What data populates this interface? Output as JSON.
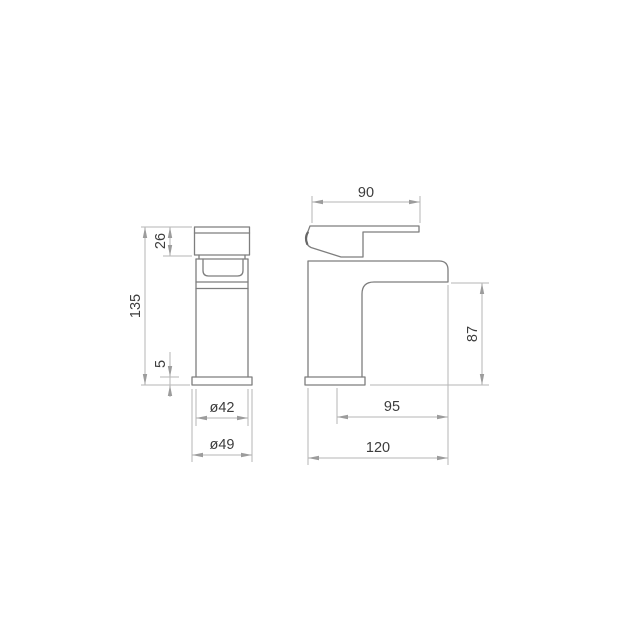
{
  "page": {
    "background": "#ffffff"
  },
  "drawing": {
    "title": "basin-mixer-tap-dimension-drawing",
    "units": "mm",
    "palette": {
      "object_line": "#7e7e7e",
      "dimension_line": "#b6b6b6",
      "arrow": "#9c9c9c",
      "text": "#3d3d3d",
      "background": "#ffffff"
    },
    "front_view": {
      "dimensions": {
        "total_height": "135",
        "handle_height": "26",
        "base_plate_height": "5",
        "body_diameter": "ø42",
        "base_diameter": "ø49"
      }
    },
    "side_view": {
      "dimensions": {
        "handle_length": "90",
        "spout_clearance_height": "87",
        "spout_projection": "95",
        "total_depth": "120"
      }
    }
  }
}
